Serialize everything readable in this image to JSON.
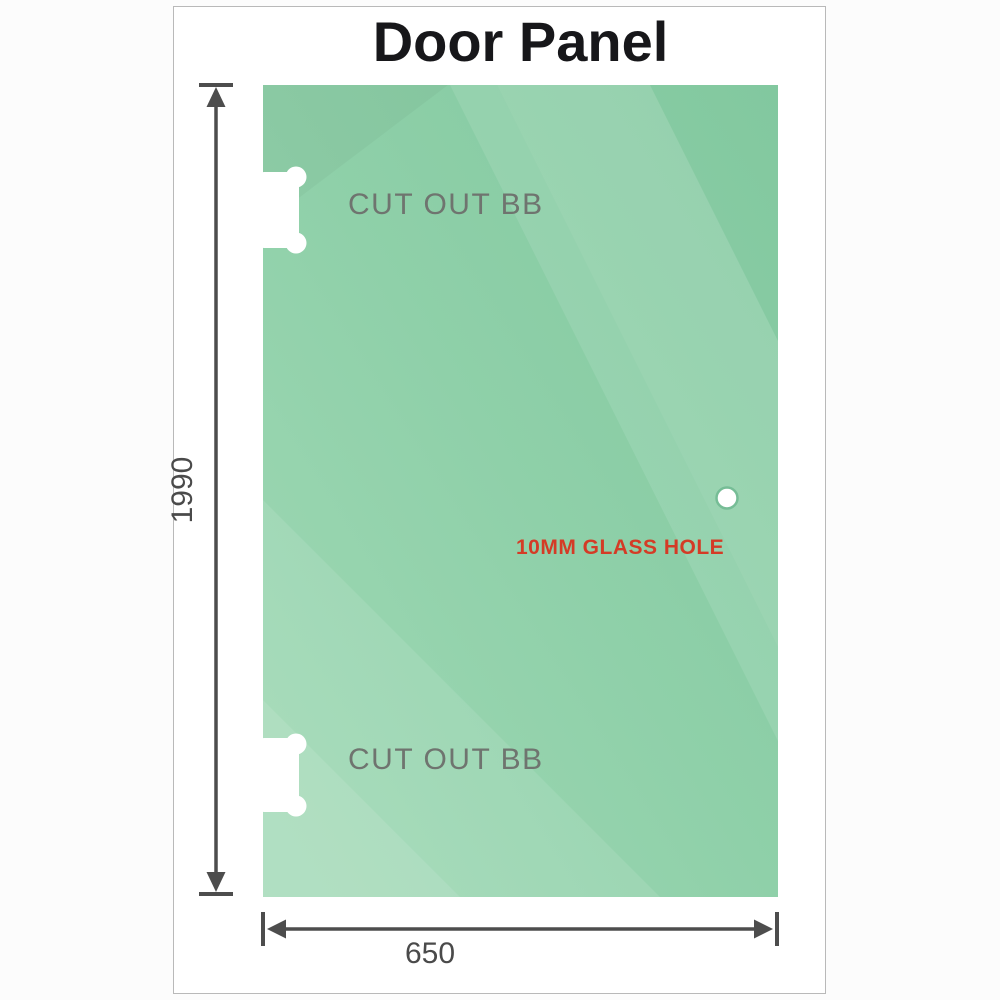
{
  "window": {
    "title": "Door Panel"
  },
  "panel": {
    "cutouts": [
      {
        "label": "CUT OUT BB"
      },
      {
        "label": "CUT OUT BB"
      }
    ],
    "hole": {
      "label": "10MM GLASS HOLE"
    }
  },
  "dimensions": {
    "height": "1990",
    "width": "650"
  },
  "colors": {
    "glass_green_dark": "#82c89f",
    "glass_green_mid": "#8fd0a9",
    "glass_green_light": "#a0d9b5",
    "hole_ring_green": "#76bd96",
    "dimension_gray": "#4d4d4d",
    "cutout_label_gray": "#6f746f",
    "hole_label_red": "#d43b26",
    "title_black": "#17171a",
    "frame_border_gray": "#b9b9b9"
  }
}
